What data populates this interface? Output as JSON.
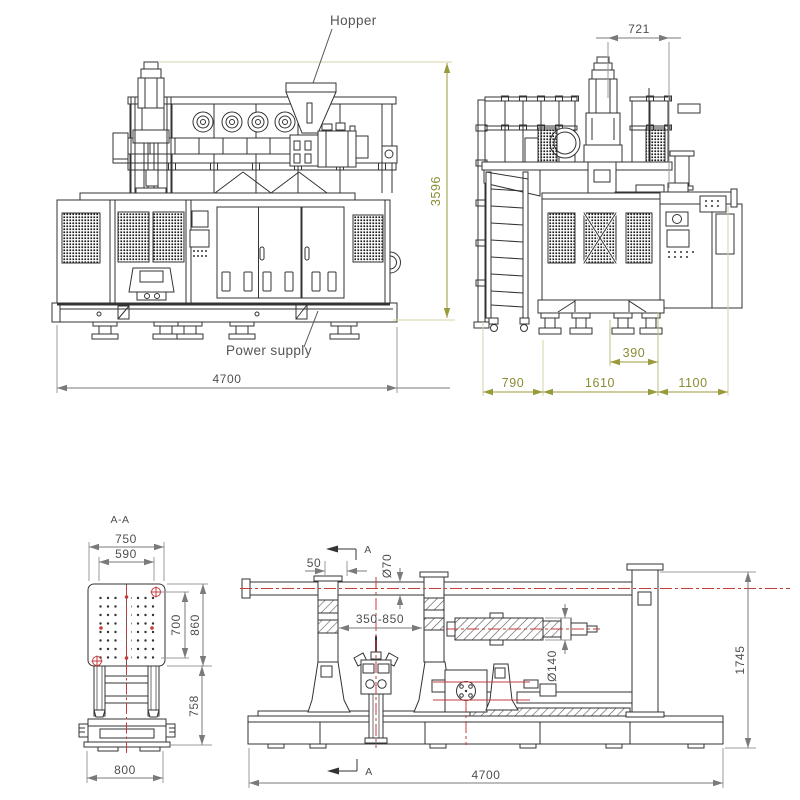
{
  "labels": {
    "hopper": "Hopper",
    "power_supply": "Power supply",
    "section_title": "A-A",
    "section_marker": "A"
  },
  "front_view": {
    "dim_height": "3596",
    "dim_width": "4700"
  },
  "side_view": {
    "dim_top": "721",
    "dim_foot": "390",
    "dim_left": "790",
    "dim_mid": "1610",
    "dim_right": "1100"
  },
  "section_view": {
    "dim_plate_w": "750",
    "dim_bolt_w": "590",
    "dim_bolt_h": "700",
    "dim_plate_h": "860",
    "dim_leg_h": "758",
    "dim_base_w": "800"
  },
  "layout_view": {
    "dim_offset": "50",
    "dim_rod": "Ø70",
    "dim_stroke": "350-850",
    "dim_shaft": "Ø140",
    "dim_height": "1745",
    "dim_length": "4700"
  },
  "colors": {
    "machine_line": "#333333",
    "dim_gray": "#7a7a7a",
    "dim_olive": "#9a9a3c",
    "ext_pale": "#d6d6a8",
    "centerline_red": "#c43c3c"
  }
}
